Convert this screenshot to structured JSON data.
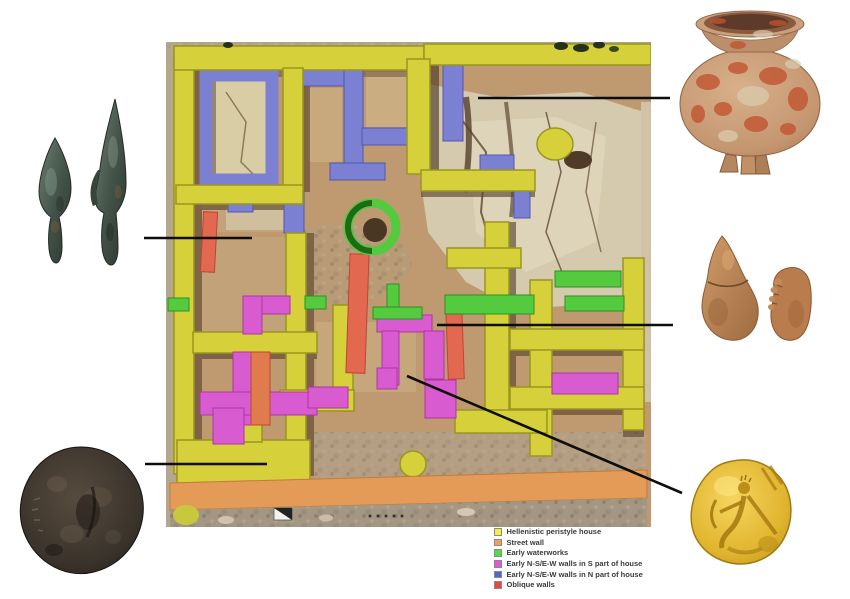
{
  "canvas": {
    "width": 850,
    "height": 599,
    "background": "#ffffff"
  },
  "site_plan": {
    "name": "aerial orthophoto of excavated Hellenistic house",
    "position": {
      "x": 166,
      "y": 42,
      "width": 485,
      "height": 485
    }
  },
  "legend": {
    "items": [
      {
        "label": "Hellenistic peristyle house",
        "color": "#f2ef3d"
      },
      {
        "label": "Street wall",
        "color": "#f0a058"
      },
      {
        "label": "Early waterworks",
        "color": "#4ede49"
      },
      {
        "label": "Early N-S/E-W walls in S part of house",
        "color": "#e557d6"
      },
      {
        "label": "Early N-S/E-W walls in N part of house",
        "color": "#4c67d6"
      },
      {
        "label": "Oblique walls",
        "color": "#ea4440"
      }
    ]
  },
  "artifacts": [
    {
      "id": "arrowheads",
      "name": "two bronze arrowheads",
      "position": "top-left"
    },
    {
      "id": "pot",
      "name": "red-painted globular pot",
      "position": "top-right"
    },
    {
      "id": "figurines",
      "name": "terracotta figurine fragments",
      "position": "middle-right"
    },
    {
      "id": "bronze-coin",
      "name": "bronze coin",
      "position": "bottom-left"
    },
    {
      "id": "gold-coin",
      "name": "gold coin with archer",
      "position": "bottom-right"
    }
  ],
  "callouts": [
    {
      "artifact": "arrowheads",
      "line": {
        "x1": 144,
        "y1": 238,
        "x2": 252,
        "y2": 238
      }
    },
    {
      "artifact": "pot",
      "line": {
        "x1": 478,
        "y1": 98,
        "x2": 670,
        "y2": 98
      }
    },
    {
      "artifact": "figurines",
      "line": {
        "x1": 437,
        "y1": 325,
        "x2": 673,
        "y2": 325
      }
    },
    {
      "artifact": "bronze-coin",
      "line": {
        "x1": 145,
        "y1": 464,
        "x2": 267,
        "y2": 464
      }
    },
    {
      "artifact": "gold-coin",
      "line": {
        "x1": 407,
        "y1": 376,
        "x2": 682,
        "y2": 493
      }
    }
  ]
}
